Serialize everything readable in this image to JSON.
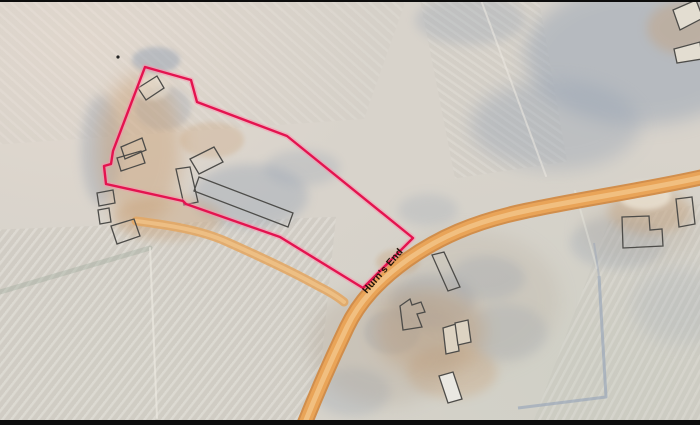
{
  "map": {
    "road_label": {
      "text": "Hurn's End",
      "x": 369,
      "y": 297,
      "angle_deg": -49
    },
    "palette": {
      "field_base": "#d8d3cb",
      "trees": "#96a3b4",
      "farm_tan": "#c79b6e",
      "brown_gray": "#b0a292",
      "bright": "#efe8da",
      "road_edge": "#d18a45",
      "road_main": "#e9a458",
      "road_center": "#f2c285",
      "lane_main": "#e2a765",
      "lane_center": "#eec288",
      "boundary": "#e4134f",
      "boundary_halo": "#ff8fac",
      "building_outline": "#4d4c49",
      "ditch_blue": "#93a1b7",
      "hedgerow": "#8fa08f",
      "field_line_light": "#eceae2",
      "border_black": "#0c0c0c",
      "marker_dot": "#222222"
    },
    "boundary": {
      "points": "145,67 191,80 197,102 287,136 413,238 363,288 280,237 186,204 183,201 106,184 104,166 111,164 113,151"
    },
    "marker_dot": {
      "x": 118,
      "y": 57,
      "r": 1.6
    },
    "roads": [
      {
        "name": "main-road",
        "path": "M703,177 C645,190 575,200 525,211 C473,222 438,238 407,260 C378,281 359,302 347,327 C334,354 318,390 304,425",
        "layers": [
          {
            "color": "road_edge",
            "width": 16,
            "opacity": 0.95
          },
          {
            "color": "road_main",
            "width": 12,
            "opacity": 1
          },
          {
            "color": "road_center",
            "width": 5,
            "opacity": 0.9
          }
        ]
      },
      {
        "name": "farm-lane",
        "path": "M136,221 C168,225 200,230 225,241 C252,253 295,273 318,286 C330,292 338,297 344,302",
        "layers": [
          {
            "color": "lane_main",
            "width": 9,
            "opacity": 0.9
          },
          {
            "color": "lane_center",
            "width": 4,
            "opacity": 0.85
          }
        ]
      }
    ],
    "ditches": [
      {
        "d": "M599,276 L606,397 L518,408",
        "width": 3,
        "opacity": 0.6
      },
      {
        "d": "M594,243 L599,276",
        "width": 2,
        "opacity": 0.4
      }
    ],
    "field_lines": [
      {
        "d": "M0,292 L150,248",
        "color": "hedgerow",
        "width": 5,
        "opacity": 0.3
      },
      {
        "d": "M150,248 L157,418",
        "color": "field_line_light",
        "width": 2,
        "opacity": 0.65
      },
      {
        "d": "M481,0 L546,176",
        "color": "field_line_light",
        "width": 2,
        "opacity": 0.55
      },
      {
        "d": "M575,191 L597,268",
        "color": "field_line_light",
        "width": 2,
        "opacity": 0.4
      }
    ],
    "terrain_patches": [
      {
        "cx": 640,
        "cy": 55,
        "rx": 115,
        "ry": 70,
        "fill": "trees",
        "opacity": 0.5,
        "blur": "lg",
        "name": "woodland-top-right"
      },
      {
        "cx": 555,
        "cy": 125,
        "rx": 85,
        "ry": 45,
        "fill": "trees",
        "opacity": 0.4,
        "blur": "lg",
        "name": "woodland-top-right"
      },
      {
        "cx": 470,
        "cy": 20,
        "rx": 55,
        "ry": 25,
        "fill": "trees",
        "opacity": 0.3,
        "blur": "md",
        "name": "woodland-top-right"
      },
      {
        "cx": 156,
        "cy": 60,
        "rx": 24,
        "ry": 13,
        "fill": "trees",
        "opacity": 0.5,
        "blur": "sm",
        "name": "tree-shadow"
      },
      {
        "cx": 101,
        "cy": 150,
        "rx": 20,
        "ry": 55,
        "fill": "trees",
        "opacity": 0.38,
        "blur": "md",
        "name": "tree-shadow"
      },
      {
        "cx": 163,
        "cy": 108,
        "rx": 28,
        "ry": 22,
        "fill": "trees",
        "opacity": 0.3,
        "blur": "sm",
        "name": "tree-shadow"
      },
      {
        "cx": 250,
        "cy": 196,
        "rx": 58,
        "ry": 32,
        "fill": "trees",
        "opacity": 0.38,
        "blur": "md",
        "name": "farmyard-shadow"
      },
      {
        "cx": 302,
        "cy": 168,
        "rx": 38,
        "ry": 18,
        "fill": "trees",
        "opacity": 0.28,
        "blur": "md",
        "name": "farmyard-shadow"
      },
      {
        "cx": 433,
        "cy": 302,
        "rx": 42,
        "ry": 28,
        "fill": "trees",
        "opacity": 0.38,
        "blur": "md",
        "name": "tree-shadow"
      },
      {
        "cx": 487,
        "cy": 278,
        "rx": 38,
        "ry": 22,
        "fill": "trees",
        "opacity": 0.3,
        "blur": "md",
        "name": "tree-shadow"
      },
      {
        "cx": 505,
        "cy": 332,
        "rx": 42,
        "ry": 28,
        "fill": "trees",
        "opacity": 0.25,
        "blur": "md",
        "name": "tree-shadow"
      },
      {
        "cx": 392,
        "cy": 332,
        "rx": 28,
        "ry": 22,
        "fill": "trees",
        "opacity": 0.3,
        "blur": "sm",
        "name": "tree-shadow"
      },
      {
        "cx": 618,
        "cy": 243,
        "rx": 48,
        "ry": 26,
        "fill": "trees",
        "opacity": 0.28,
        "blur": "md",
        "name": "tree-shadow"
      },
      {
        "cx": 680,
        "cy": 305,
        "rx": 48,
        "ry": 38,
        "fill": "trees",
        "opacity": 0.18,
        "blur": "lg",
        "name": "tree-shadow"
      },
      {
        "cx": 352,
        "cy": 392,
        "rx": 38,
        "ry": 24,
        "fill": "trees",
        "opacity": 0.28,
        "blur": "md",
        "name": "tree-shadow"
      },
      {
        "cx": 428,
        "cy": 210,
        "rx": 30,
        "ry": 16,
        "fill": "trees",
        "opacity": 0.25,
        "blur": "md",
        "name": "tree-shadow"
      },
      {
        "cx": 140,
        "cy": 150,
        "rx": 42,
        "ry": 75,
        "fill": "farm_tan",
        "opacity": 0.42,
        "blur": "lg",
        "name": "farm-ground"
      },
      {
        "cx": 168,
        "cy": 218,
        "rx": 55,
        "ry": 22,
        "fill": "farm_tan",
        "opacity": 0.35,
        "blur": "md",
        "name": "farm-ground"
      },
      {
        "cx": 430,
        "cy": 332,
        "rx": 55,
        "ry": 42,
        "fill": "farm_tan",
        "opacity": 0.4,
        "blur": "lg",
        "name": "farm-ground"
      },
      {
        "cx": 452,
        "cy": 372,
        "rx": 45,
        "ry": 26,
        "fill": "farm_tan",
        "opacity": 0.3,
        "blur": "md",
        "name": "farm-ground"
      },
      {
        "cx": 650,
        "cy": 212,
        "rx": 42,
        "ry": 22,
        "fill": "farm_tan",
        "opacity": 0.38,
        "blur": "md",
        "name": "farm-ground"
      },
      {
        "cx": 682,
        "cy": 28,
        "rx": 35,
        "ry": 26,
        "fill": "farm_tan",
        "opacity": 0.35,
        "blur": "md",
        "name": "farm-ground"
      },
      {
        "cx": 212,
        "cy": 140,
        "rx": 32,
        "ry": 18,
        "fill": "farm_tan",
        "opacity": 0.28,
        "blur": "sm",
        "name": "farm-ground"
      },
      {
        "cx": 398,
        "cy": 262,
        "rx": 22,
        "ry": 13,
        "fill": "farm_tan",
        "opacity": 0.3,
        "blur": "sm",
        "name": "farm-ground"
      },
      {
        "cx": 385,
        "cy": 345,
        "rx": 75,
        "ry": 60,
        "fill": "brown_gray",
        "opacity": 0.3,
        "blur": "lg",
        "name": "farm-ground"
      },
      {
        "cx": 470,
        "cy": 300,
        "rx": 90,
        "ry": 70,
        "fill": "brown_gray",
        "opacity": 0.2,
        "blur": "lg",
        "name": "farm-ground"
      },
      {
        "cx": 640,
        "cy": 230,
        "rx": 60,
        "ry": 30,
        "fill": "brown_gray",
        "opacity": 0.2,
        "blur": "lg",
        "name": "farm-ground"
      },
      {
        "cx": 645,
        "cy": 196,
        "rx": 26,
        "ry": 14,
        "fill": "bright",
        "opacity": 0.7,
        "blur": "sm",
        "name": "bright-yard"
      },
      {
        "cx": 152,
        "cy": 88,
        "rx": 18,
        "ry": 12,
        "fill": "bright",
        "opacity": 0.45,
        "blur": "sm",
        "name": "bright-yard"
      }
    ],
    "buildings": [
      {
        "points": "138,88 157,76 164,88 146,100"
      },
      {
        "points": "121,147 142,138 146,150 125,159"
      },
      {
        "points": "117,158 141,151 145,163 121,171"
      },
      {
        "points": "190,159 214,147 223,162 199,174"
      },
      {
        "points": "176,169 190,167 198,202 184,205"
      },
      {
        "points": "199,177 293,213 288,227 194,191"
      },
      {
        "points": "97,193 113,190 115,203 99,206"
      },
      {
        "points": "98,210 109,208 111,222 100,224"
      },
      {
        "points": "111,226 134,219 140,236 117,244"
      },
      {
        "points": "432,255 444,252 460,287 448,291"
      },
      {
        "d": "M400,306 L410,299 L412,305 L421,302 L425,312 L417,314 L422,327 L403,330 Z"
      },
      {
        "points": "443,328 456,324 459,351 446,354",
        "fill": "#ddd3c2"
      },
      {
        "points": "455,323 468,320 471,342 458,345",
        "fill": "#ddd3c2"
      },
      {
        "points": "439,376 453,372 462,399 448,403",
        "fill": "#eae8e2"
      },
      {
        "d": "M622,217 L649,216 L650,230 L662,229 L663,246 L623,248 Z"
      },
      {
        "points": "676,199 692,197 695,224 679,227"
      },
      {
        "points": "673,10 696,0 703,18 680,30",
        "fill": "#e3ddd1"
      },
      {
        "points": "674,49 700,42 702,59 677,63",
        "fill": "#e3ddd1"
      }
    ]
  }
}
